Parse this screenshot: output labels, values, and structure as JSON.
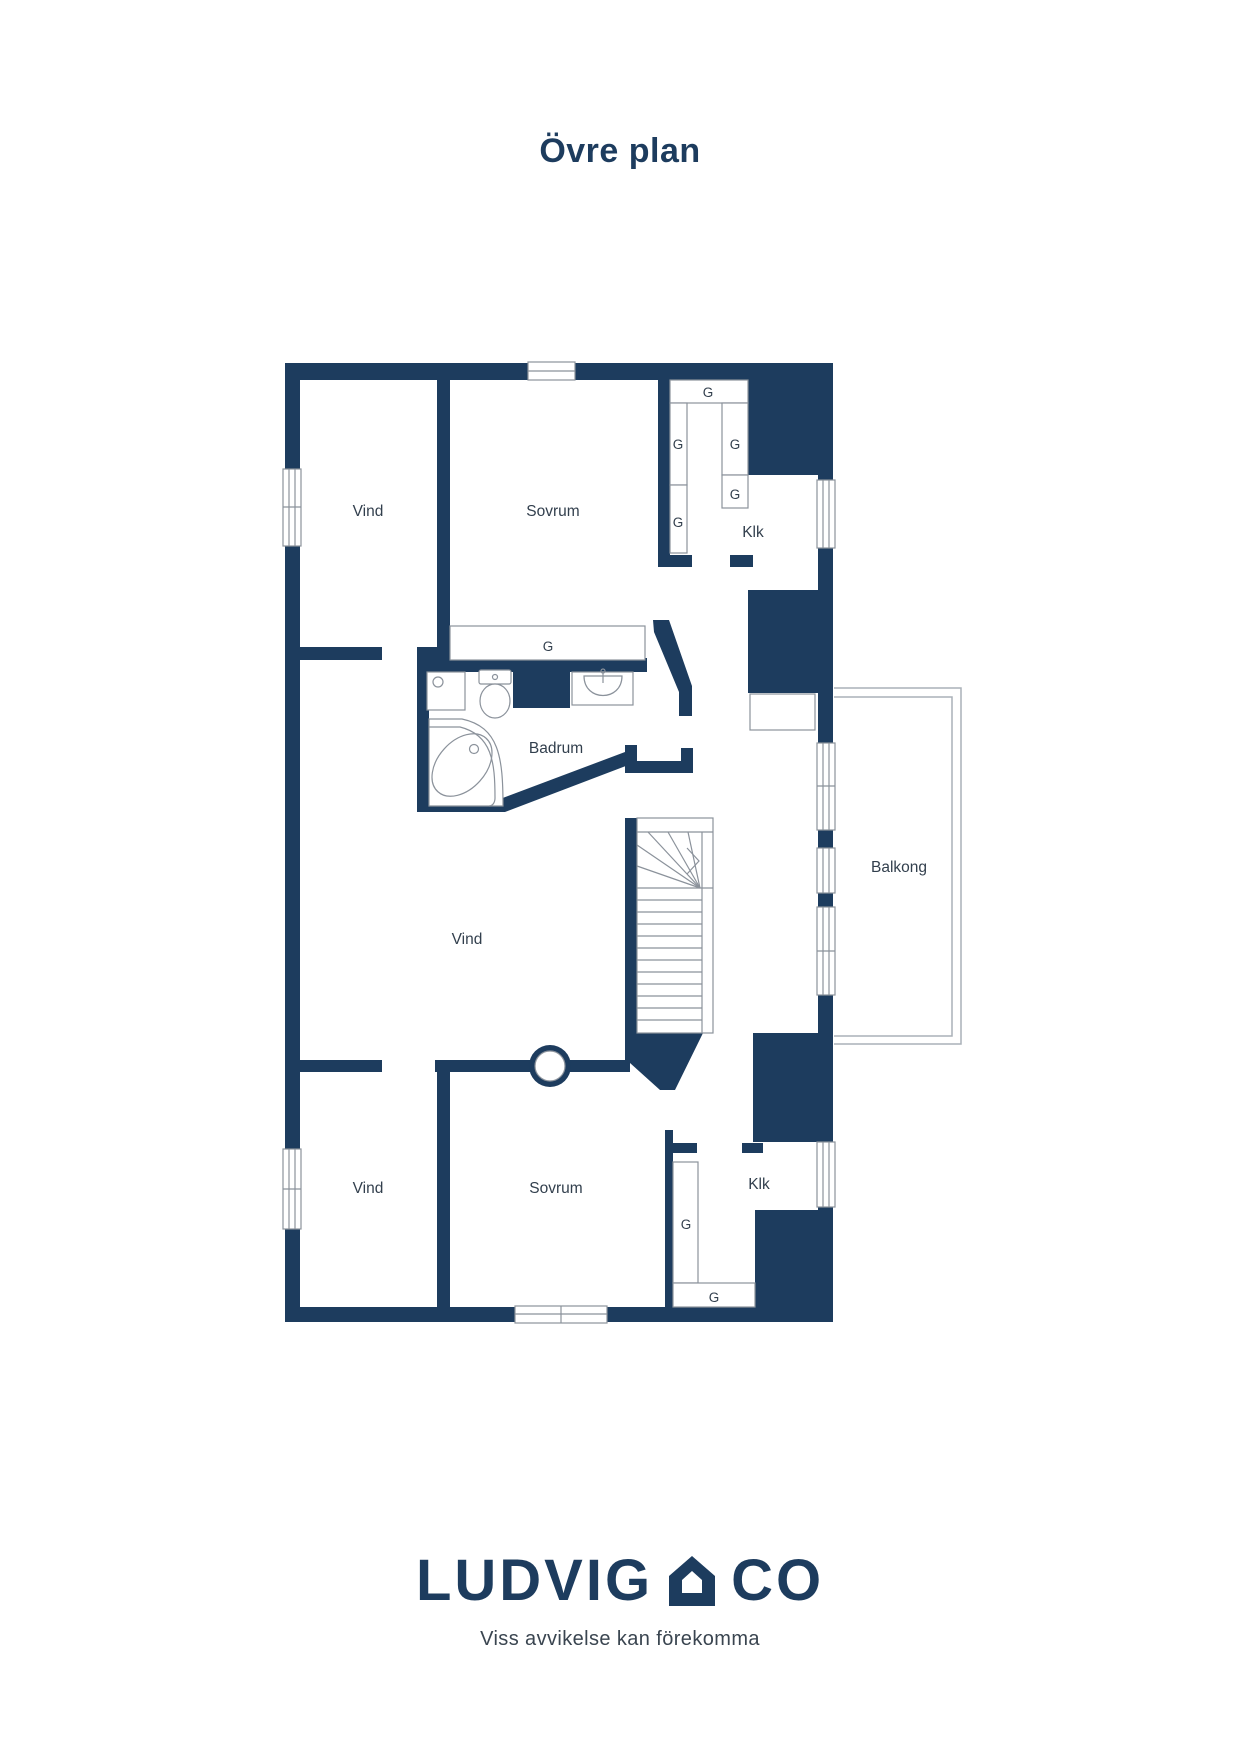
{
  "page": {
    "title": "Övre plan"
  },
  "floorplan": {
    "rooms": [
      {
        "id": "vind-upper",
        "label": "Vind"
      },
      {
        "id": "sovrum-upper",
        "label": "Sovrum"
      },
      {
        "id": "klk-upper",
        "label": "Klk"
      },
      {
        "id": "badrum",
        "label": "Badrum"
      },
      {
        "id": "vind-middle",
        "label": "Vind"
      },
      {
        "id": "balkong",
        "label": "Balkong"
      },
      {
        "id": "vind-lower",
        "label": "Vind"
      },
      {
        "id": "sovrum-lower",
        "label": "Sovrum"
      },
      {
        "id": "klk-lower",
        "label": "Klk"
      }
    ],
    "wardrobes": [
      {
        "id": "wardrobe-top-wide",
        "label": "G"
      },
      {
        "id": "wardrobe-left-upper",
        "label": "G"
      },
      {
        "id": "wardrobe-right-col",
        "label": "G"
      },
      {
        "id": "wardrobe-right-small",
        "label": "G"
      },
      {
        "id": "wardrobe-left-lower",
        "label": "G"
      },
      {
        "id": "wardrobe-sovrum-wide",
        "label": "G"
      },
      {
        "id": "wardrobe-klk-vertical",
        "label": "G"
      },
      {
        "id": "wardrobe-klk-bottom",
        "label": "G"
      }
    ],
    "colors": {
      "wall": "#1d3c5e",
      "fixture_line": "#8b929b",
      "balcony_line": "#aab1b8",
      "label_text": "#323f4d"
    }
  },
  "footer": {
    "brand_left": "LUDVIG",
    "brand_right": "CO",
    "tagline": "Viss avvikelse kan förekomma"
  }
}
